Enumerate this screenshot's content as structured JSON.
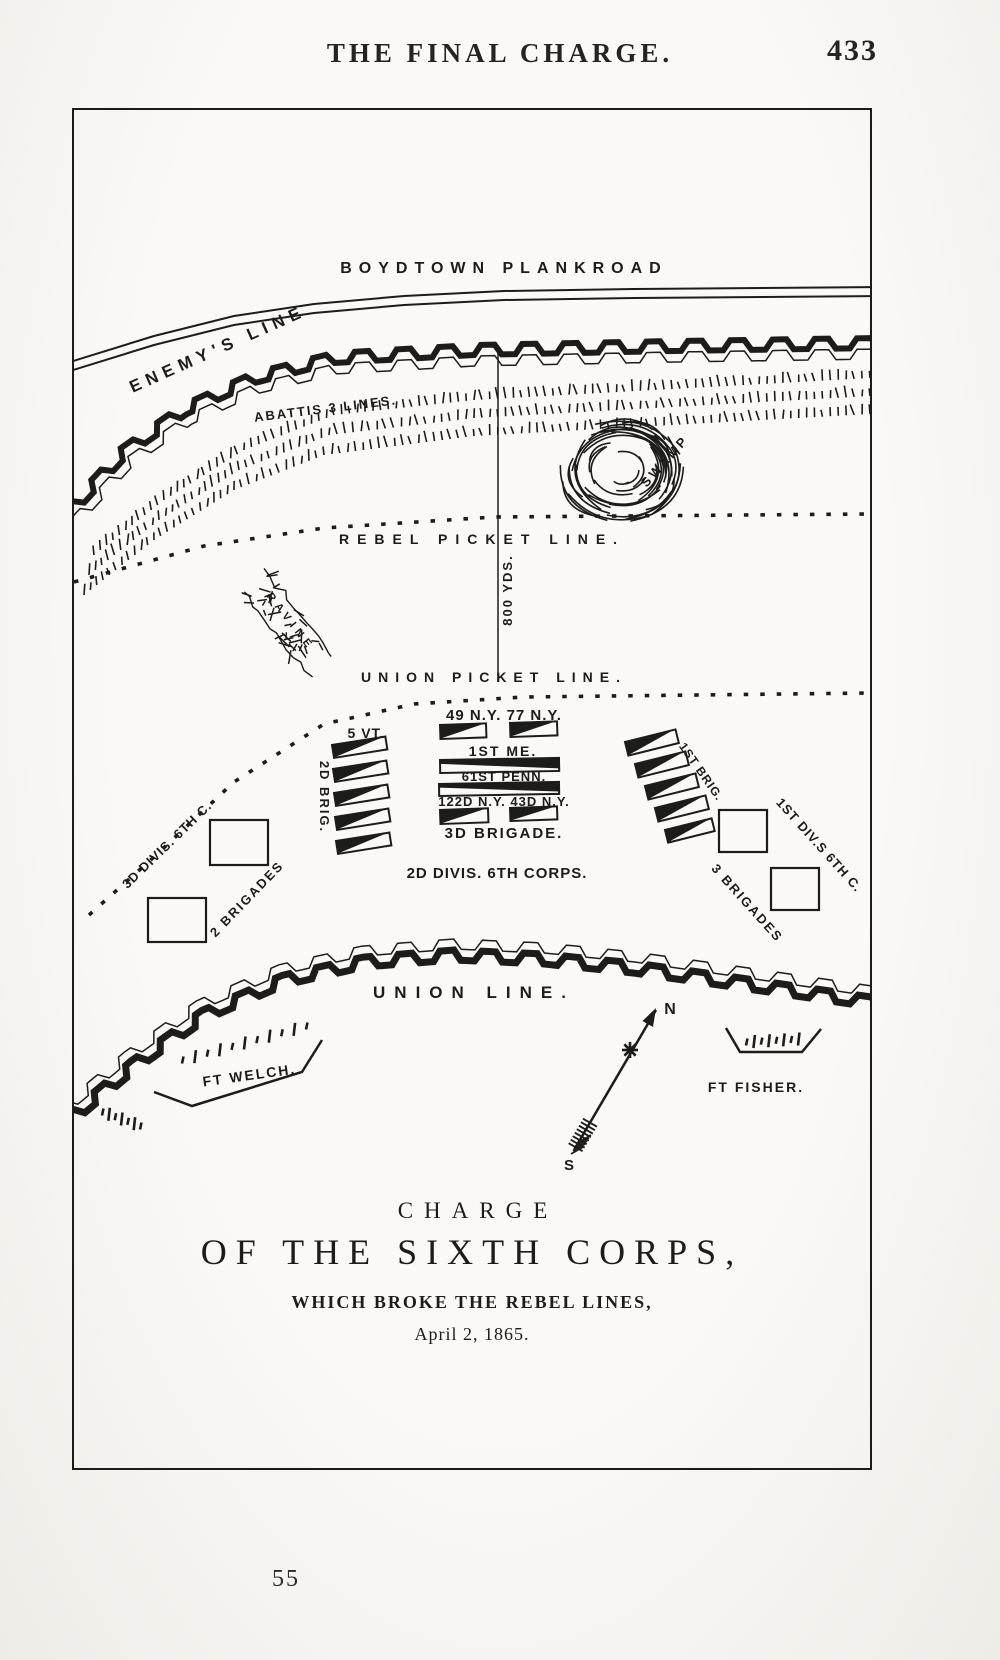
{
  "page": {
    "header_title": "THE FINAL CHARGE.",
    "page_number_top": "433",
    "page_number_bottom": "55"
  },
  "map": {
    "road_label": "BOYDTOWN PLANKROAD",
    "enemy_line_label": "ENEMY'S LINE",
    "abattis_label": "ABATTIS 3 LINES.",
    "swamp_label": "SWAMP",
    "rebel_picket_label": "REBEL PICKET LINE.",
    "distance_label": "800 YDS.",
    "ravine_label": "RAVINE",
    "union_picket_label": "UNION PICKET LINE.",
    "units": {
      "ny_49_77": "49 N.Y. 77 N.Y.",
      "me_1": "1ST ME.",
      "penn_61": "61ST PENN.",
      "ny_122_43": "122D N.Y. 43D N.Y.",
      "brigade_3": "3D BRIGADE.",
      "vt_5": "5 VT.",
      "brig_2": "2D BRIG.",
      "divis_2_corps": "2D DIVIS. 6TH CORPS.",
      "divis_3": "3D DIVIS. 6TH C.",
      "brigades_2": "2 BRIGADES",
      "brig_1": "1ST BRIG.",
      "div_1": "1ST DIV.S 6TH C.",
      "brigades_3": "3 BRIGADES"
    },
    "union_line_label": "UNION  LINE.",
    "fort_welch_label": "FT WELCH.",
    "fort_fisher_label": "FT FISHER.",
    "compass_north": "N",
    "compass_south": "S",
    "title_block": {
      "line1": "CHARGE",
      "line2": "OF THE SIXTH CORPS,",
      "line3": "WHICH BROKE THE REBEL LINES,",
      "line4": "April 2, 1865."
    }
  }
}
